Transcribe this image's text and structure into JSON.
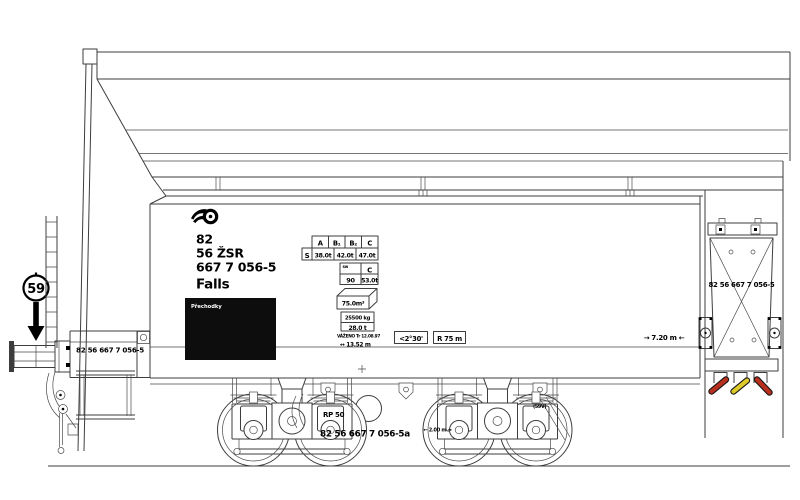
{
  "wagon": {
    "registration": {
      "line1": "82",
      "line2": "56 ŽSR",
      "line3": "667 7 056-5",
      "class": "Falls"
    },
    "numbers": {
      "buffer_end": "82 56 667 7 056-5",
      "end_wall": "82 56 667 7 056-5",
      "bogie": "82 56 667 7 056-5a"
    }
  },
  "load_table": {
    "col_headers": [
      "A",
      "B₁",
      "B₂",
      "C"
    ],
    "row_label": "S",
    "loads": [
      "38.0t",
      "42.0t",
      "47.0t"
    ]
  },
  "speed_table": {
    "corner": "sw",
    "col_header": "C",
    "speed": "90",
    "load": "53.0t"
  },
  "inscriptions": {
    "gauge_sign": "59",
    "panel": "Přechodky",
    "volume": "75.0m³",
    "brake_weight": "25500 kg",
    "tare": "28.0 t",
    "weighed": "VÁŽENO Tr 12.08.97",
    "length_over_buffers": "↔ 13.52 m",
    "ferry_angle": "<2°30'",
    "min_curve_radius": "R 75 m",
    "pivot_distance": "→ 7.20 m ←",
    "bogie_type": "RP 50",
    "bogie_wheelbase": "← 2.00 m →",
    "valve": "(59V)"
  },
  "colors": {
    "line": "#3d3d3d",
    "ink": "#000000",
    "panel_black": "#0d0d0d",
    "lever_red": "#b9301f",
    "lever_yellow": "#ddc92a"
  }
}
